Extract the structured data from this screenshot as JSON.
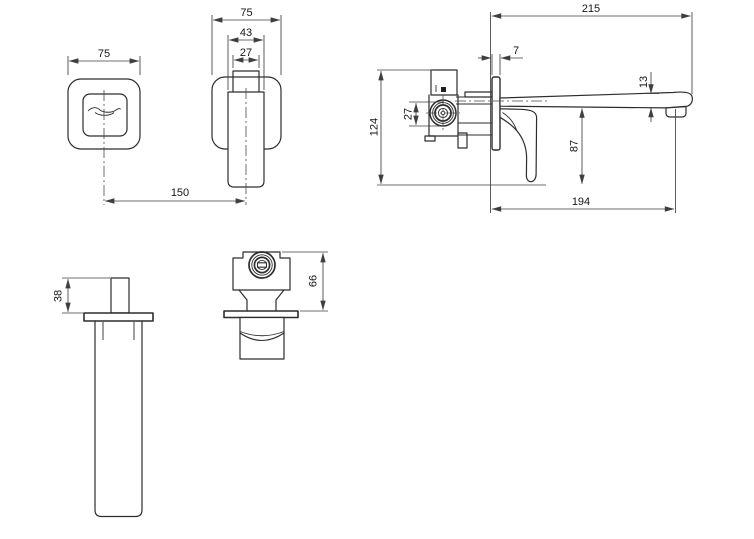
{
  "drawing": {
    "type": "technical-dimension-drawing",
    "colors": {
      "background": "#ffffff",
      "object_line": "#2d2d2d",
      "dimension_line": "#3f3f3f",
      "text": "#161616"
    },
    "dimensions": {
      "faceplate_width": "75",
      "handle_plate_width": "75",
      "handle_lever_width": "43",
      "handle_stem_width": "27",
      "handle_centres": "150",
      "spout_total_projection": "215",
      "wall_plate_thickness": "7",
      "spout_tip_height": "13",
      "concealed_body_height": "124",
      "inlet_connection": "27",
      "lever_drop": "87",
      "spout_projection": "194",
      "spout_stub_height": "38",
      "valve_body_depth": "66"
    }
  }
}
